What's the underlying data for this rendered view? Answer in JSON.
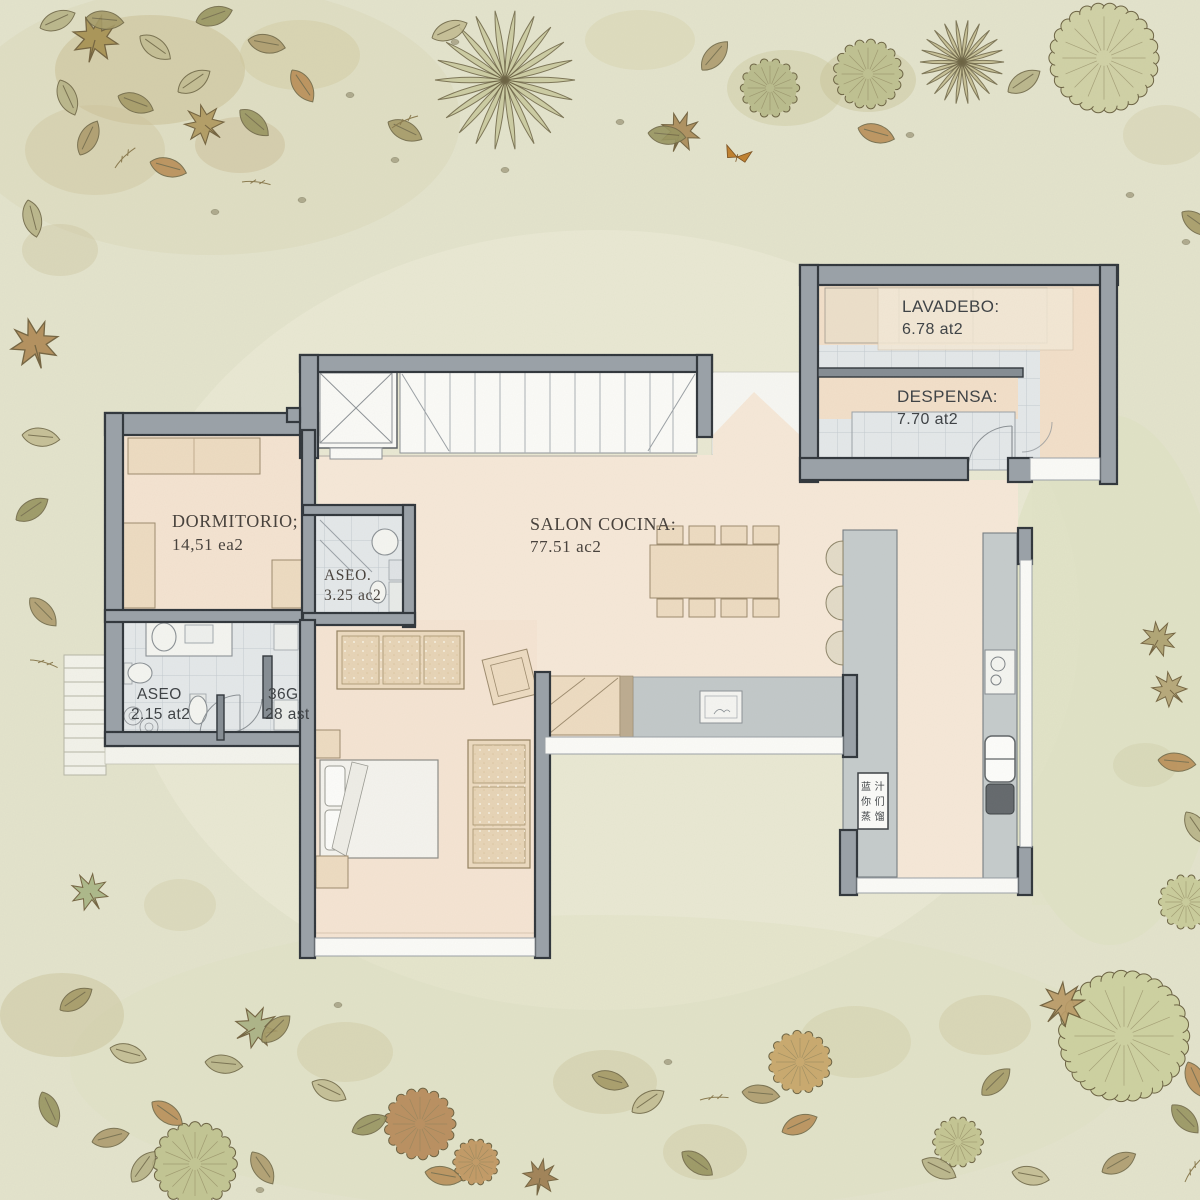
{
  "plan": {
    "rooms": {
      "lavadero": {
        "name": "LAVADEBO:",
        "area": "6.78 at2"
      },
      "despensa": {
        "name": "DESPENSA:",
        "area": "7.70 at2"
      },
      "dormitorio": {
        "name": "DORMITORIO;",
        "area": "14,51 ea2"
      },
      "aseo_small": {
        "name": "ASEO.",
        "area": "3.25 ac2"
      },
      "salon": {
        "name": "SALON COCINA:",
        "area": "77.51 ac2"
      },
      "aseo": {
        "name": "ASEO",
        "area": "2.15 at2"
      },
      "armario": {
        "name": "36G",
        "area": "28 ast"
      }
    },
    "island_label_lines": [
      "蓝 汁",
      "你 们",
      "蒸 馏"
    ]
  },
  "colors": {
    "background": "#e3e3cc",
    "floor_peach": "#f6e8d8",
    "wall_gray": "#99a1a8",
    "tile_gray": "#e4e8ea",
    "furniture_tan": "#eddbc1",
    "counter_gray": "#c5cbcc",
    "foliage_olive": "#b9bc8d",
    "foliage_brown": "#a98a55"
  }
}
